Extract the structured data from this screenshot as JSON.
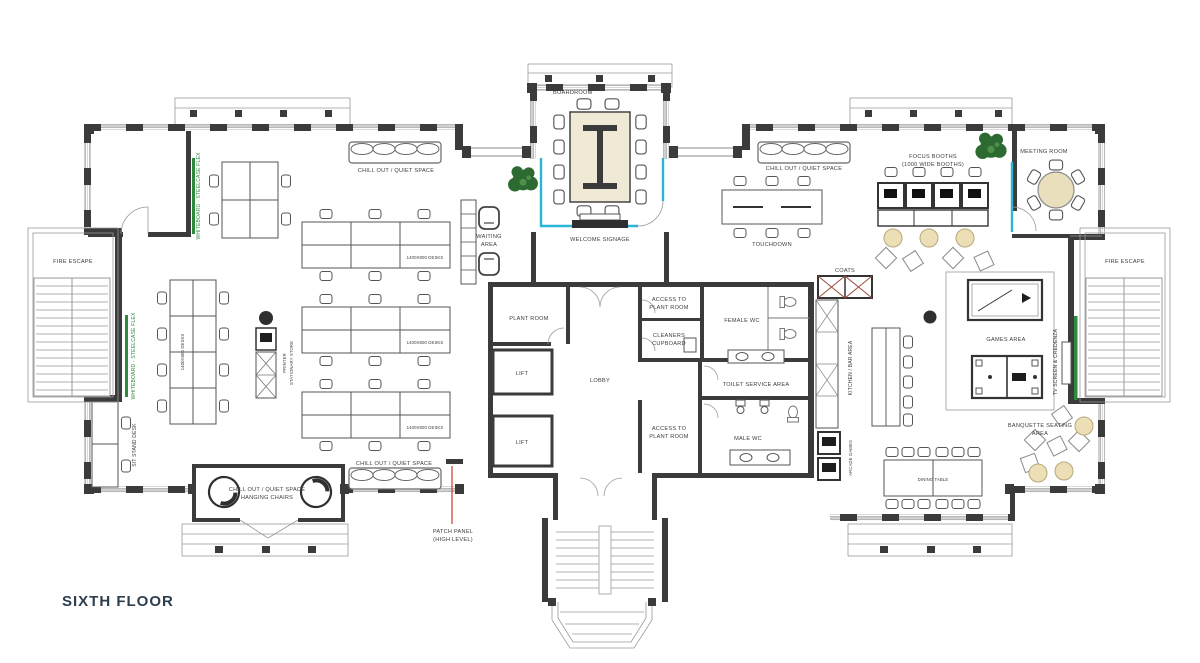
{
  "title": "SIXTH FLOOR",
  "colors": {
    "wall": "#3b3b3b",
    "glass_partition": "#29b6d4",
    "whiteboard_green": "#2e8b3d",
    "wood_beige": "#eadfbd",
    "tree_green": "#2d6a31",
    "patch_panel_red": "#cc3a2e",
    "title_text": "#2d3e4e",
    "label_text": "#3d3d3d"
  },
  "labels": {
    "boardroom": "BOARDROOM",
    "welcome_signage": "WELCOME SIGNAGE",
    "chill_out": "CHILL OUT / QUIET SPACE",
    "hanging_chairs": "HANGING CHAIRS",
    "waiting_line1": "WAITING",
    "waiting_line2": "AREA",
    "fire_escape": "FIRE ESCAPE",
    "whiteboard": "WHITEBOARD - STEELCASE FLEX",
    "sit_stand_desk": "SIT STAND DESK",
    "printer_line1": "PRINTER",
    "printer_line2": "STATIONARY STORE",
    "desks": "1400X800 DESKS",
    "plant_room": "PLANT ROOM",
    "lift": "LIFT",
    "lobby": "LOBBY",
    "access_line1": "ACCESS TO",
    "access_line2": "PLANT ROOM",
    "cleaners_line1": "CLEANERS",
    "cleaners_line2": "CUPBOARD",
    "female_wc": "FEMALE WC",
    "male_wc": "MALE WC",
    "toilet_service": "TOILET SERVICE AREA",
    "touchdown": "TOUCHDOWN",
    "focus_line1": "FOCUS BOOTHS",
    "focus_line2": "(1000 WIDE BOOTHS)",
    "meeting_room": "MEETING ROOM",
    "coats": "COATS",
    "kitchen_bar": "KITCHEN / BAR AREA",
    "games_area": "GAMES AREA",
    "tv_credenza": "TV SCREEN & CREDENZA",
    "banquette_line1": "BANQUETTE SEATING",
    "banquette_line2": "AREA",
    "dining_table": "DINING TABLE",
    "arcade_games": "ARCADE GAMES",
    "patch_line1": "PATCH PANEL",
    "patch_line2": "(HIGH LEVEL)"
  }
}
